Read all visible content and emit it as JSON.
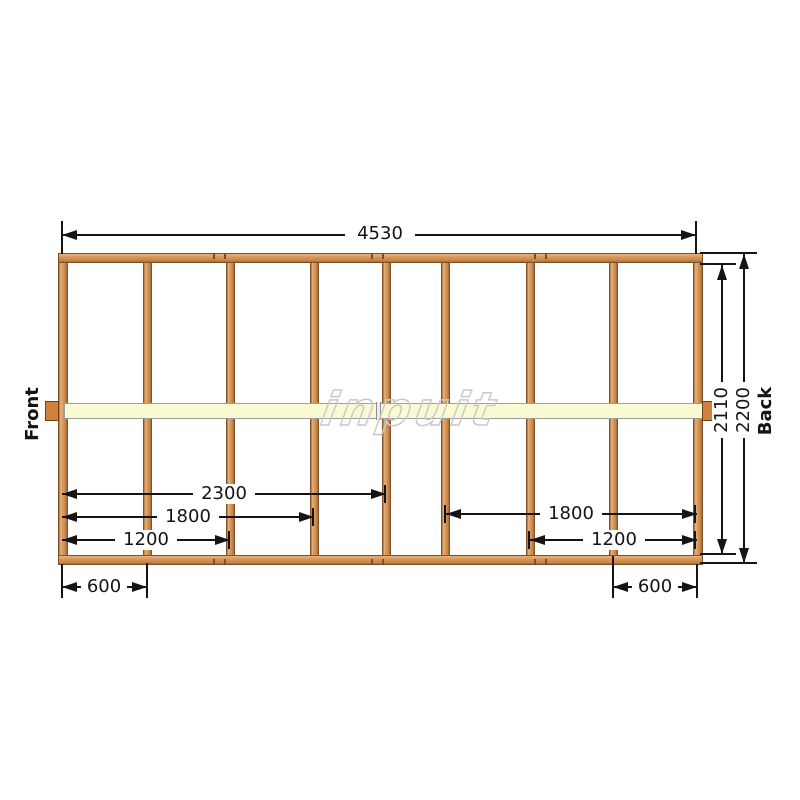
{
  "diagram": {
    "watermark": "inpuit",
    "side_labels": {
      "front": "Front",
      "back": "Back"
    },
    "dims": {
      "overall_width": "4530",
      "inner_height": "2110",
      "overall_height": "2200",
      "left_2300": "2300",
      "left_1800": "1800",
      "left_1200": "1200",
      "right_1800": "1800",
      "right_1200": "1200",
      "bottom_left_600": "600",
      "bottom_right_600": "600"
    },
    "colors": {
      "wood": "#d49458",
      "wood_border": "#7d4e22",
      "beam": "#fafad2",
      "dimension": "#141414"
    }
  }
}
